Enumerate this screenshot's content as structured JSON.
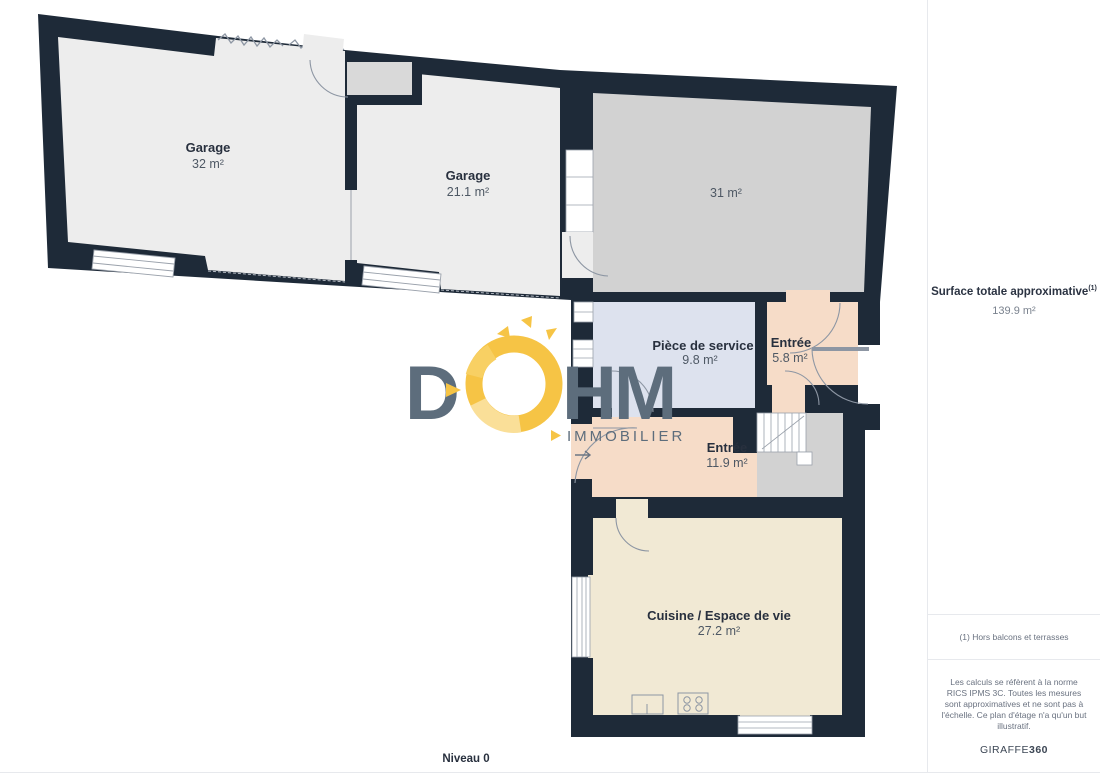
{
  "page": {
    "level_label": "Niveau 0"
  },
  "plan": {
    "rooms": [
      {
        "id": "garage-1",
        "name": "Garage",
        "area": "32 m²"
      },
      {
        "id": "garage-2",
        "name": "Garage",
        "area": "21.1 m²"
      },
      {
        "id": "room-31",
        "name": "",
        "area": "31 m²"
      },
      {
        "id": "piece-de-service",
        "name": "Pièce de service",
        "area": "9.8 m²"
      },
      {
        "id": "entree-small",
        "name": "Entrée",
        "area": "5.8 m²"
      },
      {
        "id": "entree-main",
        "name": "Entrée",
        "area": "11.9 m²"
      },
      {
        "id": "cuisine",
        "name": "Cuisine / Espace de vie",
        "area": "27.2 m²"
      }
    ],
    "colors": {
      "wall": "#1e2a38",
      "garage_floor": "#ededed",
      "room31_floor": "#d2d2d2",
      "service_floor": "#dde2ee",
      "entree_floor": "#f6dcc8",
      "cuisine_floor": "#f1e9d4",
      "landing_floor": "#d2d2d2",
      "logo_slate": "#5d6d7c",
      "logo_yellow": "#f6c445"
    }
  },
  "logo": {
    "letter_d": "D",
    "letters_hm": "HM",
    "subtitle": "IMMOBILIER"
  },
  "sidebar": {
    "total_label": "Surface totale approximative",
    "total_superscript": "(1)",
    "total_value": "139.9 m²",
    "footnote": "(1) Hors balcons et terrasses",
    "disclaimer": "Les calculs se réfèrent à la norme RICS IPMS 3C. Toutes les mesures sont approximatives et ne sont pas à l'échelle. Ce plan d'étage n'a qu'un but illustratif.",
    "brand": "GIRAFFE",
    "brand_suffix": "360"
  }
}
